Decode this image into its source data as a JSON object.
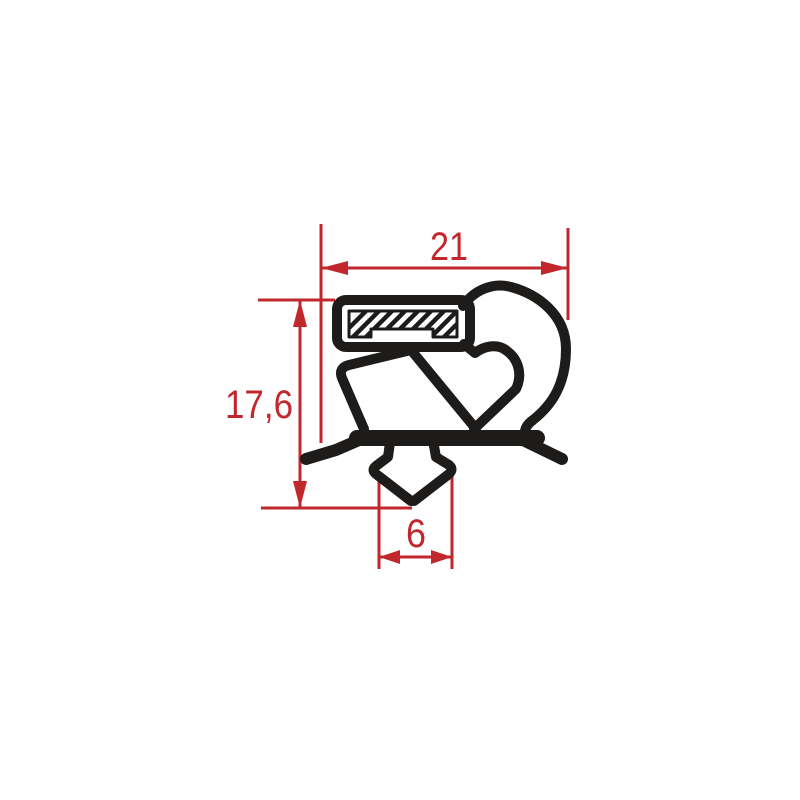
{
  "drawing": {
    "colors": {
      "dimension_red": "#c1272d",
      "profile_black": "#1d1c1a",
      "background": "#ffffff"
    },
    "dimensions": [
      {
        "id": "top-width",
        "value": "21",
        "orientation": "horizontal"
      },
      {
        "id": "left-height",
        "value": "17,6",
        "orientation": "vertical"
      },
      {
        "id": "bottom-dart-width",
        "value": "6",
        "orientation": "horizontal"
      }
    ]
  }
}
